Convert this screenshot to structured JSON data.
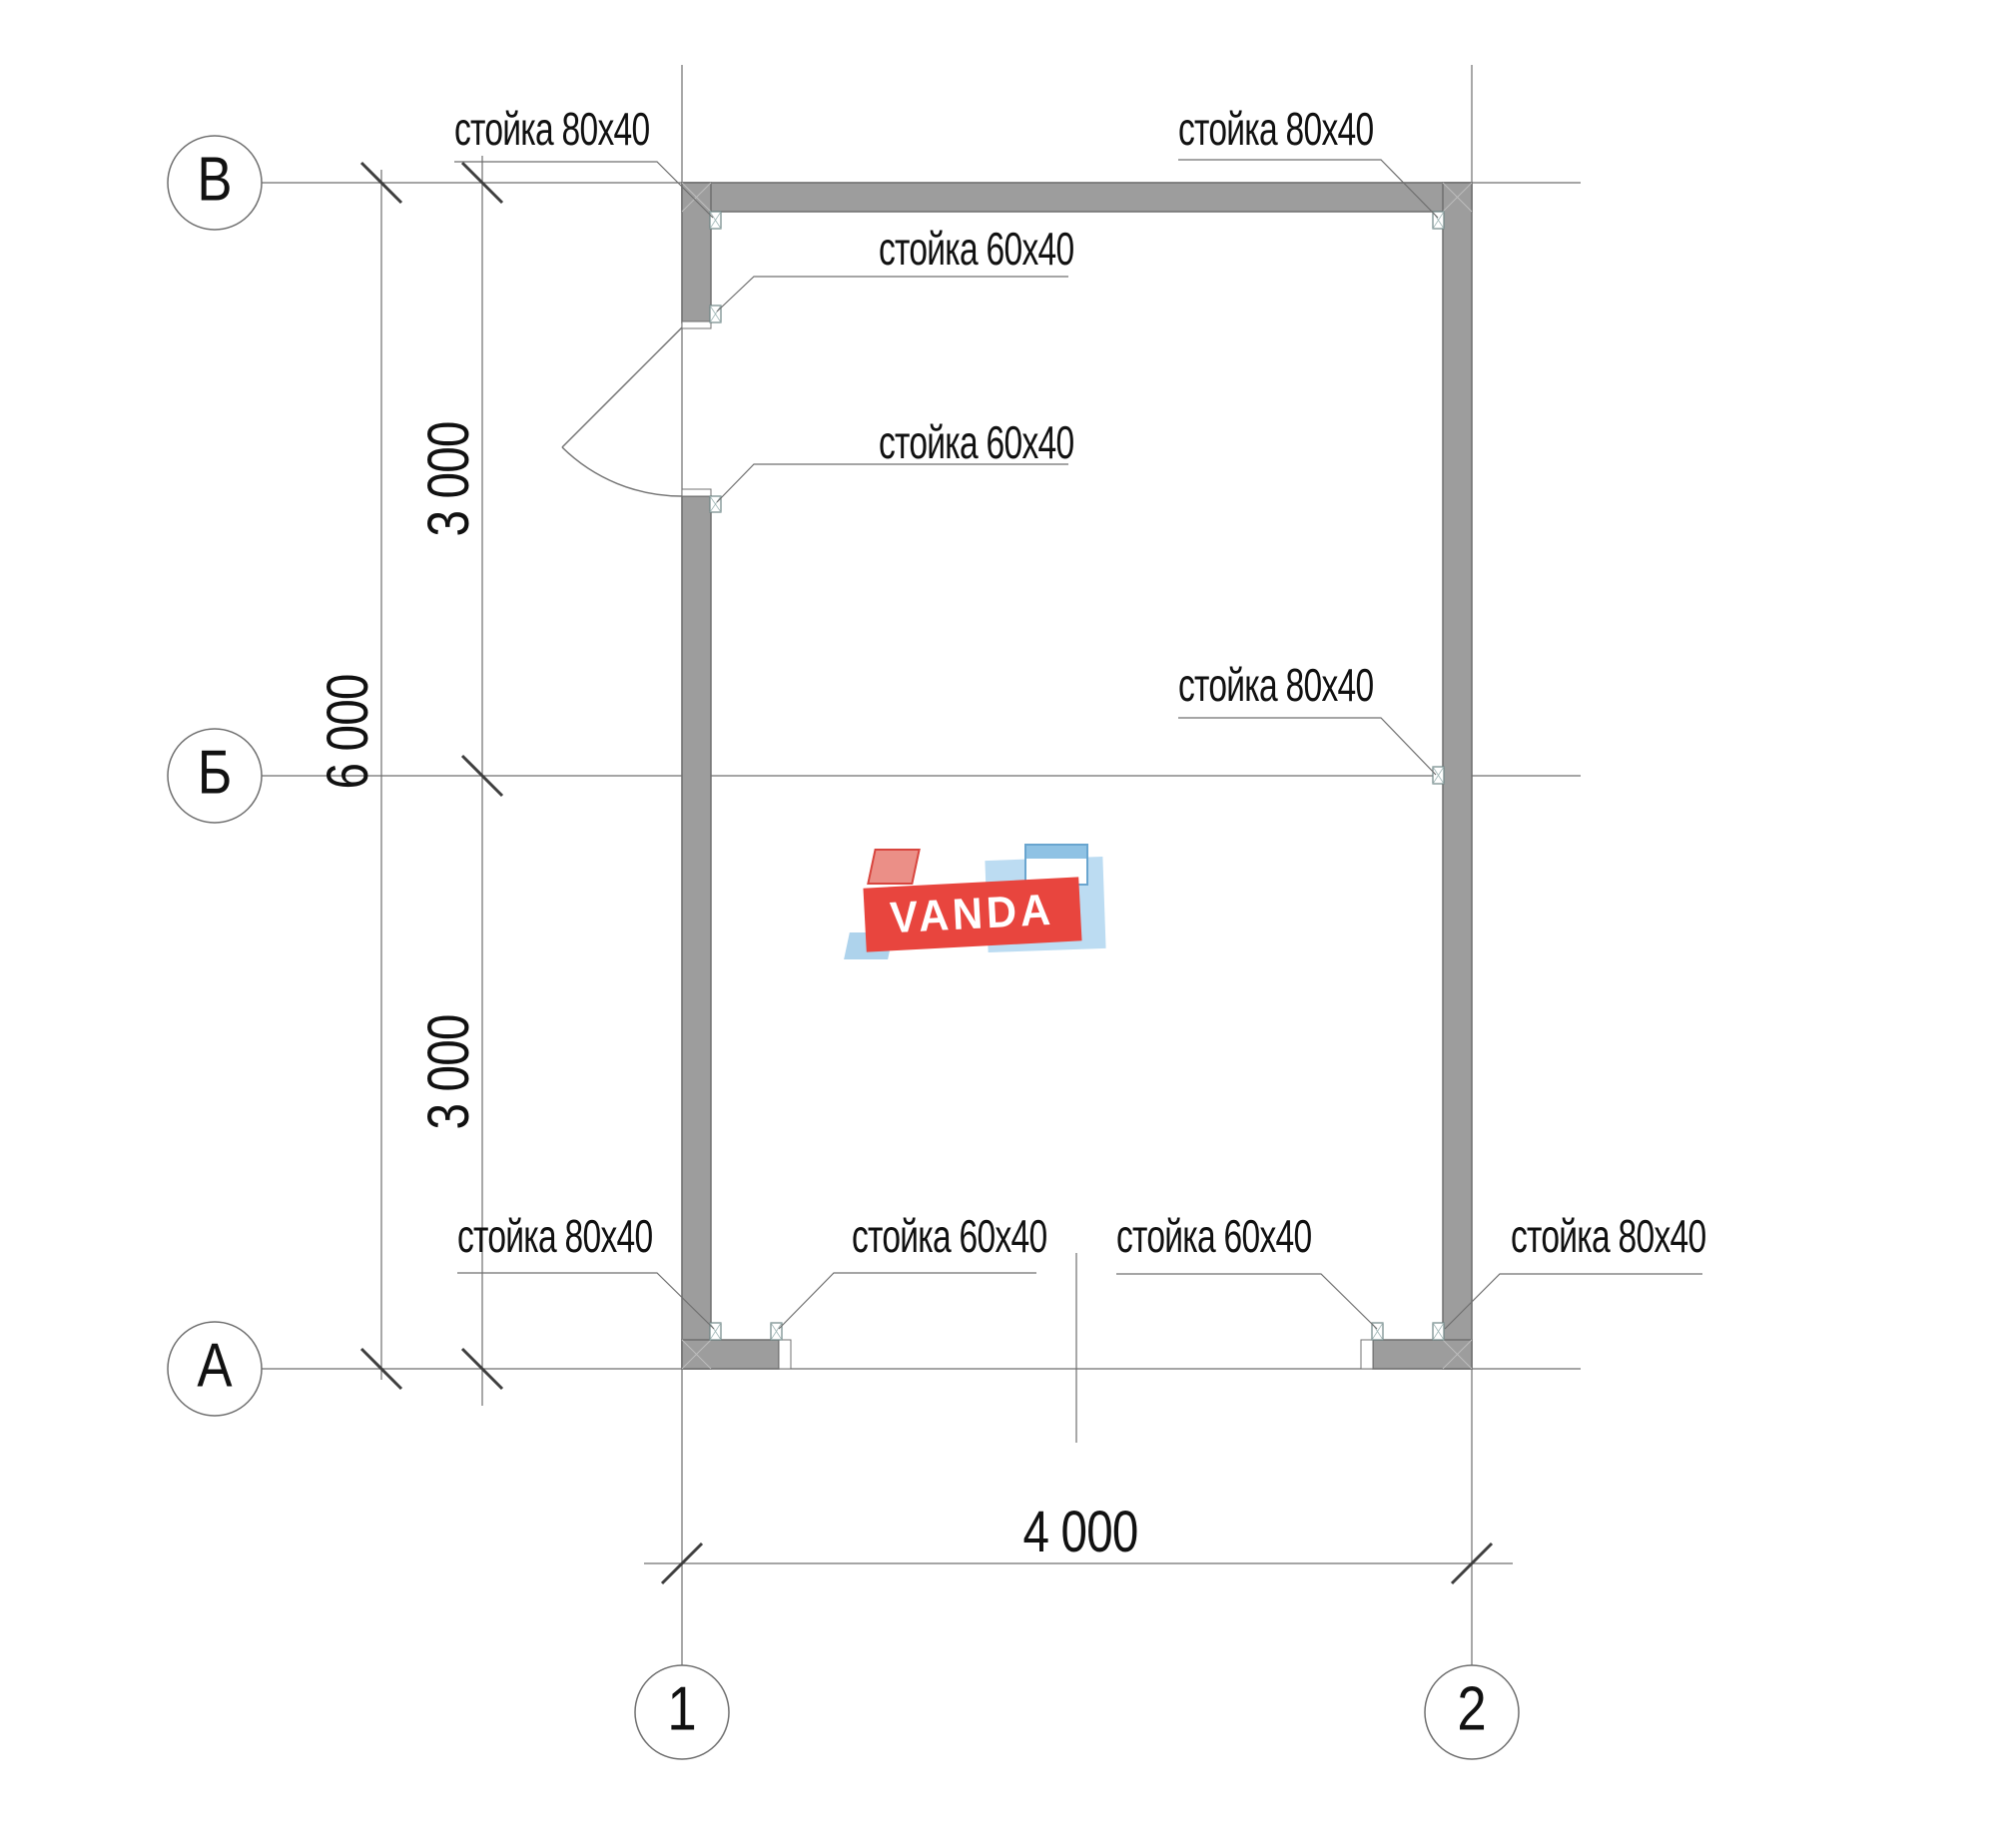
{
  "grid": {
    "rows": [
      {
        "label": "В"
      },
      {
        "label": "Б"
      },
      {
        "label": "А"
      }
    ],
    "cols": [
      {
        "label": "1"
      },
      {
        "label": "2"
      }
    ]
  },
  "dimensions": {
    "left_total": "6 000",
    "left_upper_segment": "3 000",
    "left_lower_segment": "3 000",
    "bottom_width": "4 000"
  },
  "callouts": {
    "top_left": "стойка 80x40",
    "top_right": "стойка 80x40",
    "interior_upper": "стойка 60x40",
    "interior_lower": "стойка 60x40",
    "right_mid": "стойка 80x40",
    "bottom_far_left": "стойка 80x40",
    "bottom_left": "стойка 60x40",
    "bottom_right": "стойка 60x40",
    "bottom_far_right": "стойка 80x40"
  },
  "watermark": {
    "brand": "VANDA"
  },
  "colors": {
    "wall_fill": "#9d9d9d",
    "wall_edge": "#6f6f6f",
    "line": "#6f6f6f",
    "tick": "#3f3f3f",
    "brand_red": "#e8453e",
    "brand_pink": "#eb8f87",
    "brand_blue_panel": "#bcdcf2",
    "brand_blue_strip": "#aed3ec",
    "brand_blue_top": "#8fc2e4"
  }
}
